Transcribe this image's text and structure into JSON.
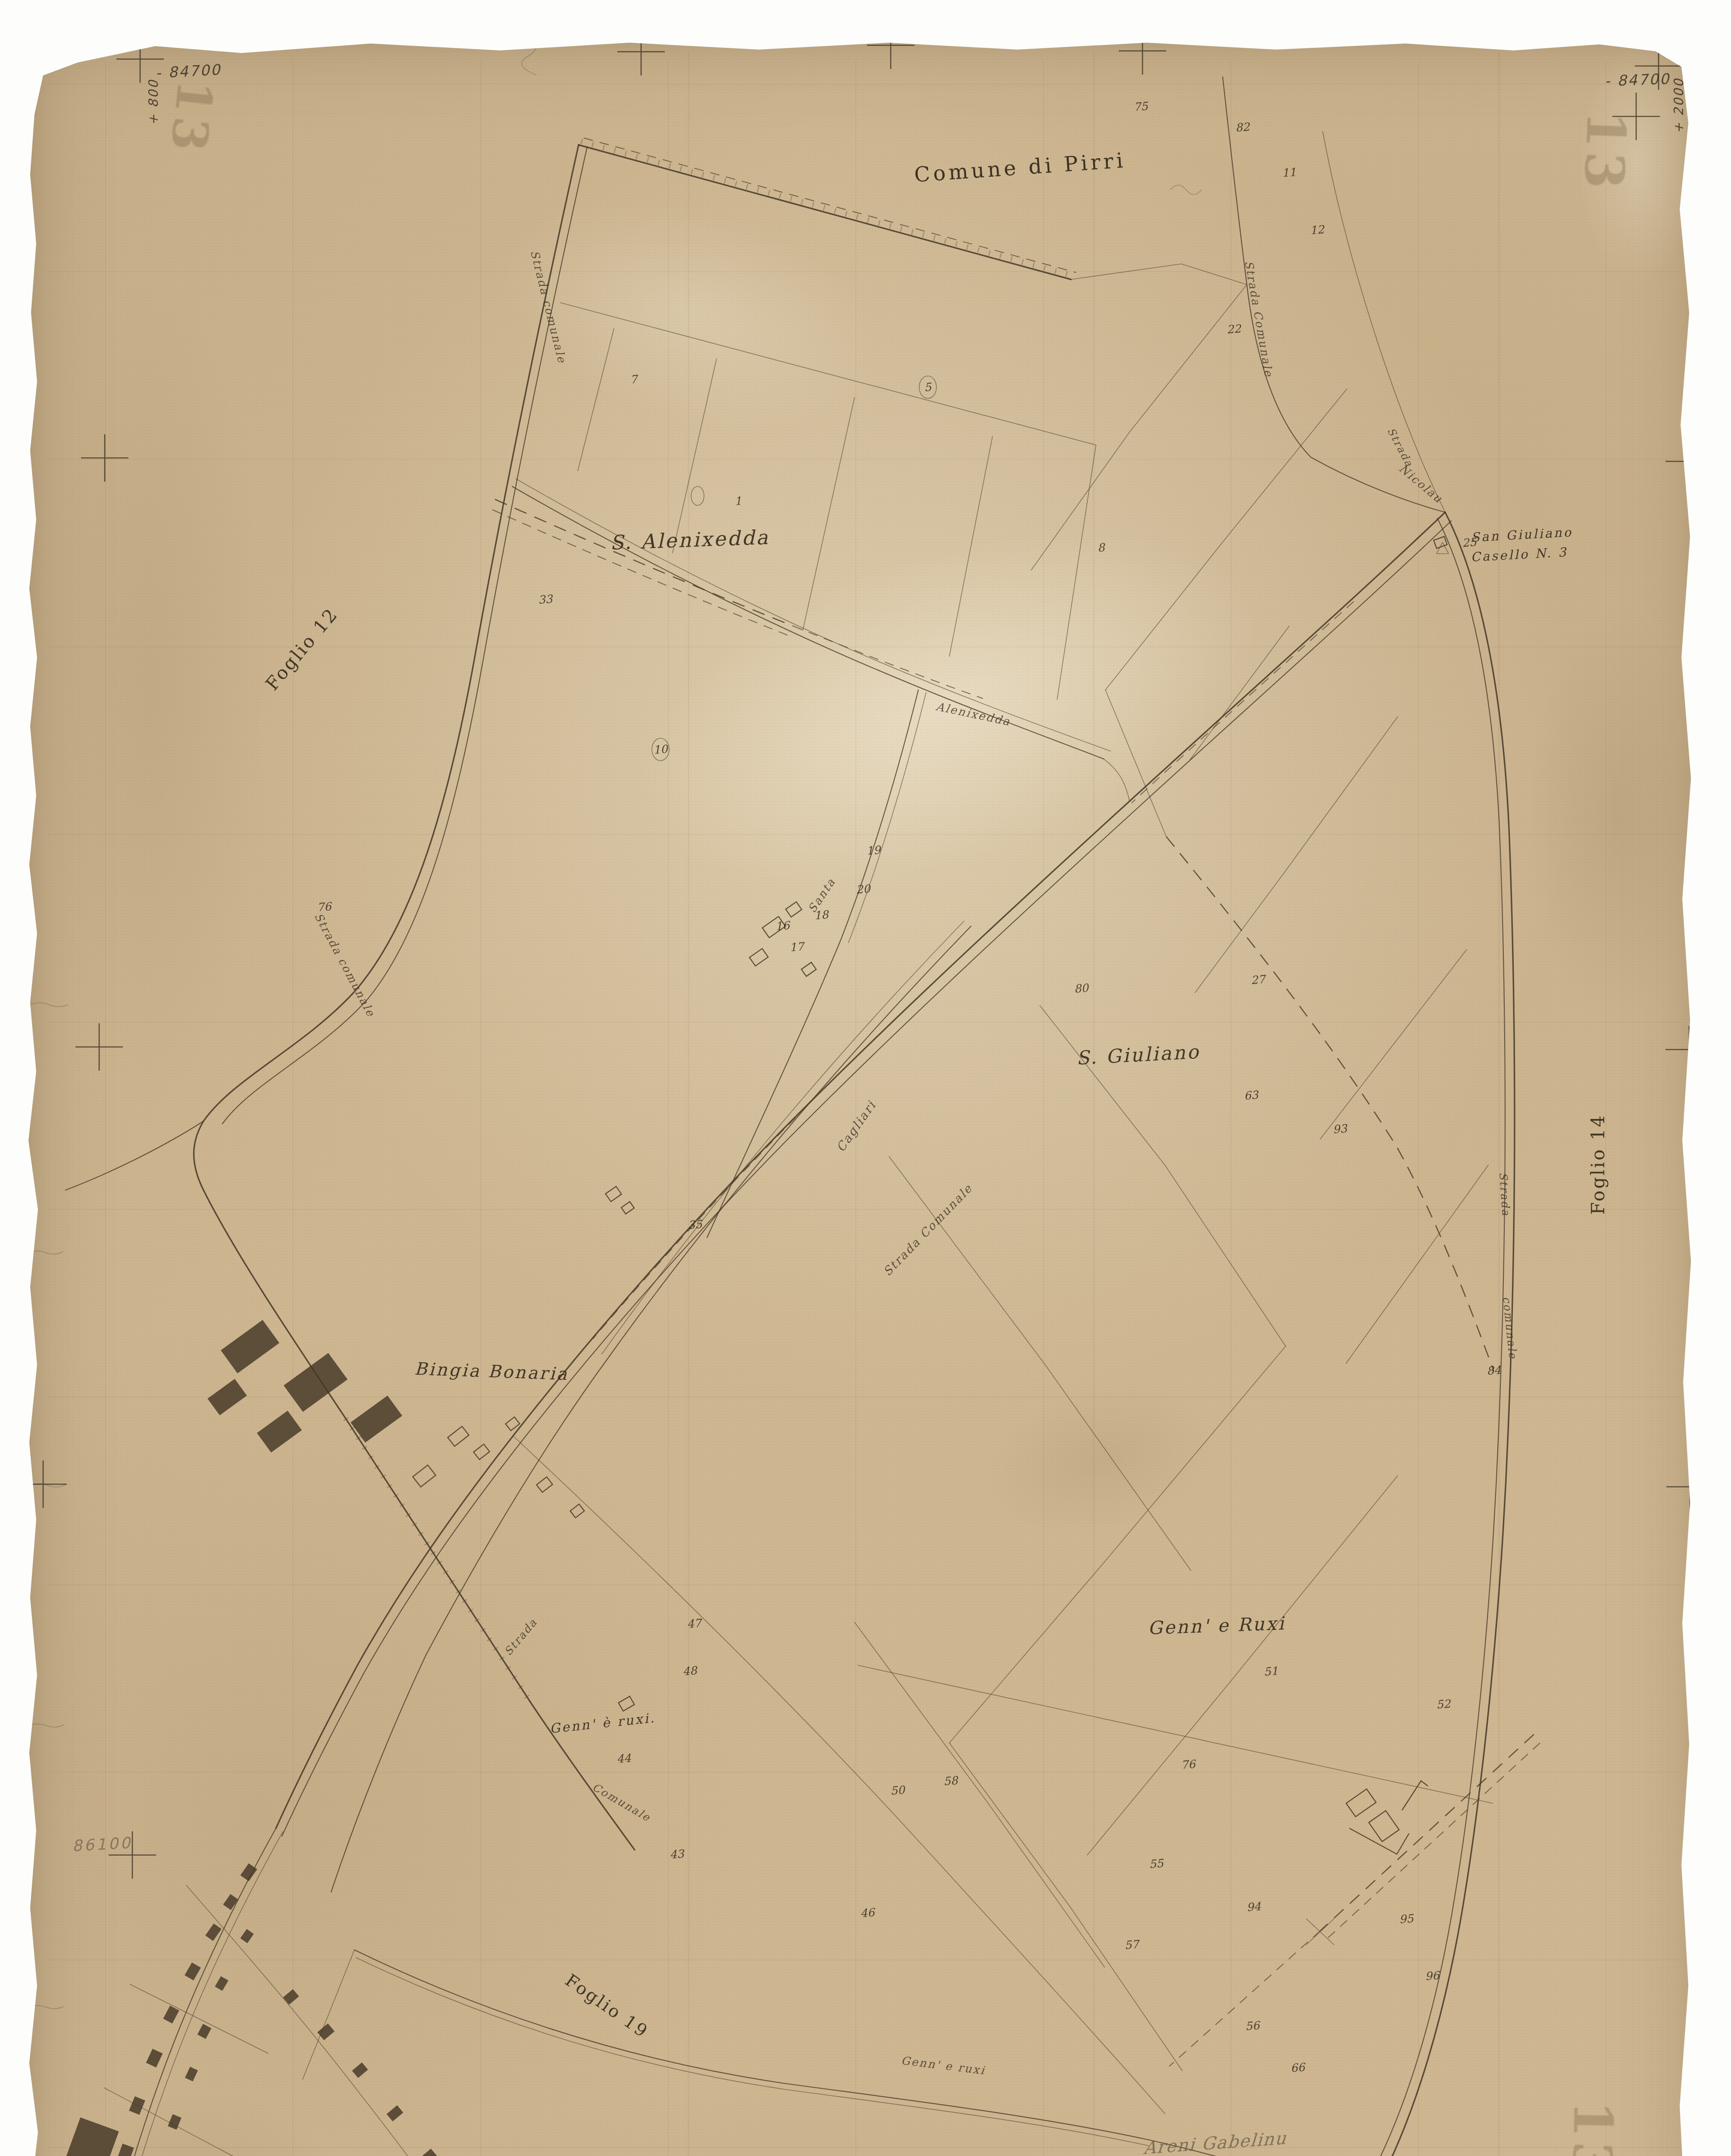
{
  "sheet": {
    "municipality_note": "Comune di Pirri",
    "title": {
      "city": "Cagliari",
      "sheet": "F.\u00b013",
      "scale": "Scala di 1 : 2000",
      "updated": "Aggiornata fino al 1932"
    },
    "sheet_number_stamp": "13"
  },
  "corner_marks": [
    {
      "name": "coord-top-left",
      "t": "- 84700",
      "x": 437,
      "y": 165,
      "rot": -3,
      "size": 34,
      "cls": "coord"
    },
    {
      "name": "coord-top-left-vertical",
      "t": "+ 800",
      "x": 355,
      "y": 237,
      "rot": -90,
      "size": 30,
      "cls": "coord"
    },
    {
      "name": "coord-top-right",
      "t": "- 84700",
      "x": 3798,
      "y": 185,
      "rot": -2,
      "size": 34,
      "cls": "coord"
    },
    {
      "name": "coord-top-right-vertical",
      "t": "+ 2000",
      "x": 3893,
      "y": 245,
      "rot": -90,
      "size": 30,
      "cls": "coord"
    },
    {
      "name": "coord-bottom-left",
      "t": "- 86500",
      "x": 385,
      "y": 5468,
      "rot": -2,
      "size": 32,
      "cls": "coord"
    },
    {
      "name": "coord-bottom-left-vertical",
      "t": "+ 800",
      "x": 315,
      "y": 5398,
      "rot": -90,
      "size": 28,
      "cls": "coord"
    },
    {
      "name": "coord-bottom-right",
      "t": "- 86500",
      "x": 3728,
      "y": 5558,
      "rot": -2,
      "size": 36,
      "cls": "coord"
    },
    {
      "name": "pencil-coordinate",
      "t": "86100",
      "x": 237,
      "y": 4277,
      "rot": -3,
      "size": 36,
      "cls": "pencil"
    }
  ],
  "stamps": [
    {
      "t": "13",
      "x": 445,
      "y": 272,
      "rot": 96,
      "size": 112
    },
    {
      "t": "13",
      "x": 3723,
      "y": 352,
      "rot": 92,
      "size": 124
    },
    {
      "t": "13",
      "x": 266,
      "y": 5273,
      "rot": 95,
      "size": 112
    },
    {
      "t": "13",
      "x": 3694,
      "y": 4966,
      "rot": 91,
      "size": 124
    }
  ],
  "place_labels": [
    {
      "name": "label-s-alenixedda",
      "t": "S. Alenixedda",
      "x": 1600,
      "y": 1252,
      "rot": -2,
      "size": 46,
      "cls": "ital"
    },
    {
      "name": "label-s-giuliano",
      "t": "S. Giuliano",
      "x": 2640,
      "y": 2446,
      "rot": -3,
      "size": 44,
      "cls": "ital"
    },
    {
      "name": "label-bingia-bonaria",
      "t": "Bingia Bonaria",
      "x": 1140,
      "y": 3180,
      "rot": 2,
      "size": 40,
      "cls": "ital"
    },
    {
      "name": "label-genn-e-ruxi",
      "t": "Genn'  e Ruxi",
      "x": 2822,
      "y": 3770,
      "rot": -2,
      "size": 42,
      "cls": "ital"
    },
    {
      "name": "label-genn-e-ruxi-small",
      "t": "Genn' \u00e8 ruxi.",
      "x": 1398,
      "y": 3996,
      "rot": -6,
      "size": 30,
      "cls": "ital"
    },
    {
      "name": "label-san-giuliano-casello",
      "t": "San Giuliano",
      "x": 3530,
      "y": 1240,
      "rot": -3,
      "size": 29,
      "cls": "ital"
    },
    {
      "name": "label-casello-n3",
      "t": "Casello N. 3",
      "x": 3524,
      "y": 1286,
      "rot": -3,
      "size": 29,
      "cls": "ital"
    }
  ],
  "adjacent_sheets": [
    {
      "name": "label-foglio-12",
      "t": "Foglio 12",
      "x": 700,
      "y": 1505,
      "rot": -50,
      "size": 42
    },
    {
      "name": "label-foglio-14",
      "t": "Foglio 14",
      "x": 3706,
      "y": 2700,
      "rot": -90,
      "size": 42
    },
    {
      "name": "label-foglio-19",
      "t": "Foglio 19",
      "x": 1408,
      "y": 4652,
      "rot": 35,
      "size": 40
    },
    {
      "name": "label-foglio-20",
      "t": "Foglio 20",
      "x": 3262,
      "y": 5200,
      "rot": -33,
      "size": 40
    }
  ],
  "road_labels": [
    {
      "t": "Strada comunale",
      "x": 1272,
      "y": 712,
      "rot": 76,
      "size": 26
    },
    {
      "t": "Strada comunale",
      "x": 800,
      "y": 2238,
      "rot": 62,
      "size": 26
    },
    {
      "t": "Strada Comunale",
      "x": 2920,
      "y": 740,
      "rot": 80,
      "size": 26
    },
    {
      "t": "Strada",
      "x": 3248,
      "y": 1038,
      "rot": 62,
      "size": 24
    },
    {
      "t": "Nicolau",
      "x": 3296,
      "y": 1122,
      "rot": 40,
      "size": 26
    },
    {
      "t": "Alenixedda",
      "x": 2258,
      "y": 1656,
      "rot": 12,
      "size": 26
    },
    {
      "t": "Santa",
      "x": 1906,
      "y": 2076,
      "rot": -56,
      "size": 26
    },
    {
      "t": "Cagliari",
      "x": 1986,
      "y": 2612,
      "rot": -55,
      "size": 28
    },
    {
      "t": "Strada Comunale",
      "x": 2152,
      "y": 2852,
      "rot": -46,
      "size": 27
    },
    {
      "t": "Strada",
      "x": 1208,
      "y": 3796,
      "rot": -50,
      "size": 25
    },
    {
      "t": "Comunale",
      "x": 1442,
      "y": 4180,
      "rot": 30,
      "size": 25
    },
    {
      "t": "Genn' e ruxi",
      "x": 2188,
      "y": 4790,
      "rot": 7,
      "size": 26
    },
    {
      "t": "Strada",
      "x": 3490,
      "y": 2770,
      "rot": 86,
      "size": 25
    },
    {
      "t": "comunale",
      "x": 3502,
      "y": 3080,
      "rot": 84,
      "size": 25
    }
  ],
  "parcel_numbers": [
    {
      "n": "1",
      "x": 1712,
      "y": 1162
    },
    {
      "n": "16",
      "x": 1815,
      "y": 2147
    },
    {
      "n": "17",
      "x": 1848,
      "y": 2196
    },
    {
      "n": "18",
      "x": 1905,
      "y": 2122
    },
    {
      "n": "19",
      "x": 2026,
      "y": 1972
    },
    {
      "n": "20",
      "x": 2002,
      "y": 2062
    },
    {
      "n": "25",
      "x": 3408,
      "y": 1258
    },
    {
      "n": "27",
      "x": 2918,
      "y": 2272
    },
    {
      "n": "80",
      "x": 2508,
      "y": 2292
    },
    {
      "n": "75",
      "x": 2646,
      "y": 247
    },
    {
      "n": "82",
      "x": 2882,
      "y": 295
    },
    {
      "n": "11",
      "x": 2990,
      "y": 400
    },
    {
      "n": "12",
      "x": 3055,
      "y": 533
    },
    {
      "n": "22",
      "x": 2862,
      "y": 763
    },
    {
      "n": "76",
      "x": 752,
      "y": 2103
    },
    {
      "n": "33",
      "x": 1265,
      "y": 1390
    },
    {
      "n": "10",
      "x": 1532,
      "y": 1738
    },
    {
      "n": "5",
      "x": 2152,
      "y": 898
    },
    {
      "n": "63",
      "x": 2902,
      "y": 2540
    },
    {
      "n": "93",
      "x": 3108,
      "y": 2618
    },
    {
      "n": "84",
      "x": 3465,
      "y": 3178
    },
    {
      "n": "35",
      "x": 1612,
      "y": 2840
    },
    {
      "n": "47",
      "x": 1610,
      "y": 3765
    },
    {
      "n": "48",
      "x": 1600,
      "y": 3875
    },
    {
      "n": "43",
      "x": 1570,
      "y": 4300
    },
    {
      "n": "44",
      "x": 1447,
      "y": 4078
    },
    {
      "n": "50",
      "x": 2082,
      "y": 4152
    },
    {
      "n": "58",
      "x": 2205,
      "y": 4130
    },
    {
      "n": "51",
      "x": 2948,
      "y": 3876
    },
    {
      "n": "52",
      "x": 3348,
      "y": 3952
    },
    {
      "n": "76",
      "x": 2756,
      "y": 4092
    },
    {
      "n": "46",
      "x": 2012,
      "y": 4436
    },
    {
      "n": "55",
      "x": 2682,
      "y": 4322
    },
    {
      "n": "94",
      "x": 2908,
      "y": 4422
    },
    {
      "n": "95",
      "x": 3262,
      "y": 4450
    },
    {
      "n": "96",
      "x": 3322,
      "y": 4582
    },
    {
      "n": "57",
      "x": 2625,
      "y": 4510
    },
    {
      "n": "56",
      "x": 2905,
      "y": 4698
    },
    {
      "n": "66",
      "x": 3010,
      "y": 4795
    },
    {
      "n": "8",
      "x": 2554,
      "y": 1270
    },
    {
      "n": "7",
      "x": 1470,
      "y": 880
    }
  ],
  "handwritten_note": {
    "lines": [
      "Areni Gabelinu",
      "Via Felis 2 3 P.",
      "Cagliari"
    ]
  }
}
